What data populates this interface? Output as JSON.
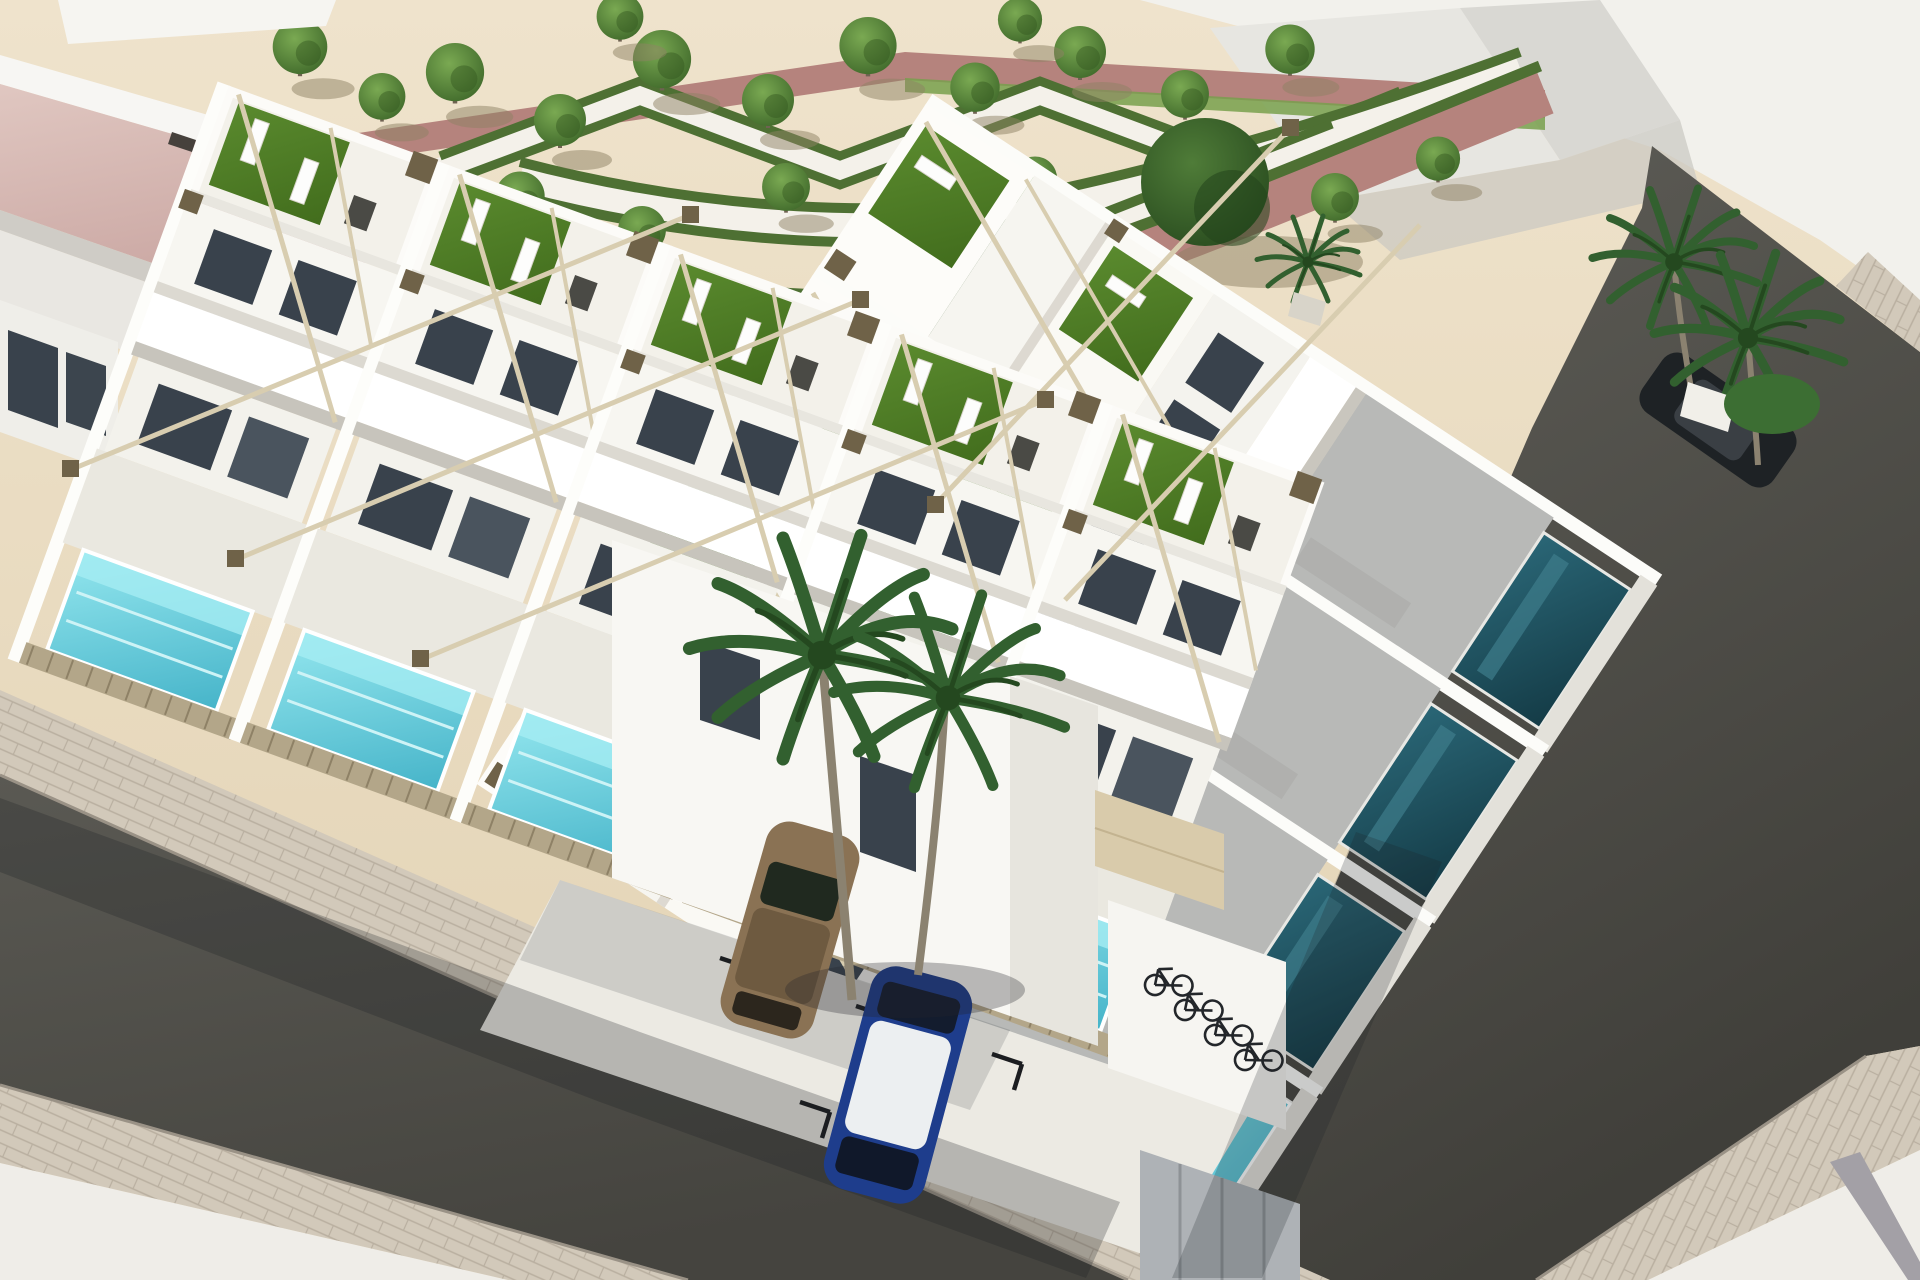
{
  "meta": {
    "title": "New-build residential complex — aerial 3D render",
    "description": "Aerial architectural rendering of a modern white townhouse development on a street corner: rooftop terraces with artificial turf and sun loungers, timber pergola beams, private plunge pools behind slatted wood fences, a landscaped park with terracotta paths, zig-zag hedges and trees, palm trees, a brown and a blue parked car, marked parking bays and a bicycle shelter, all bordered by dark asphalt streets with paver sidewalks.",
    "type": "architectural-visualization",
    "text_in_image": ""
  },
  "palette": {
    "sand": "#e8dabf",
    "sandLight": "#f0e6d2",
    "white": "#f7f6f2",
    "whiteBright": "#ffffff",
    "wallShade": "#ddd9d1",
    "glass": "#39424c",
    "turf": "#4f7c26",
    "pool": "#62cfdd",
    "poolDark": "#1d4f5c",
    "hedge": "#4e7033",
    "path": "#b5837d",
    "pinkRoof": "#d8bcb6",
    "asphalt": "#53524d",
    "paver": "#d2c9ba",
    "paverLine": "#b9afa0",
    "plaza": "#efede8",
    "stripe": "#a3a0a6",
    "wood": "#b3a689",
    "woodDark": "#8e8166",
    "beam": "#d8cdb0",
    "brownBox": "#6f6248",
    "garage": "#d9cbab",
    "carBrown": "#8a7254",
    "carBlue": "#1e3d8c",
    "carRoof": "#eceff1",
    "carDark": "#1e2225",
    "palm": "#32602f",
    "palmDark": "#24481f",
    "trunk": "#8b8270",
    "grass": "#78a04c"
  },
  "scene": {
    "park": {
      "small_trees": 20,
      "large_trees": 2,
      "hedge_pattern": "zig-zag chevrons with white walkways",
      "path_material": "terracotta"
    },
    "housing": {
      "rows": 2,
      "left_row_units": 5,
      "right_row_units": 4,
      "rooftop_terraces": true,
      "bright_pools": 4,
      "shaded_pools": 3,
      "fences": "vertical timber slats"
    },
    "streets": {
      "layout": "corner intersection",
      "surface": "dark asphalt",
      "sidewalks": "concrete pavers"
    },
    "vehicles": {
      "cars": [
        "brown hatchback",
        "blue hatchback with white roof",
        "dark car at right street"
      ],
      "bicycles": 4
    },
    "vegetation": {
      "palm_trees": 5,
      "shrubs": 1
    }
  }
}
